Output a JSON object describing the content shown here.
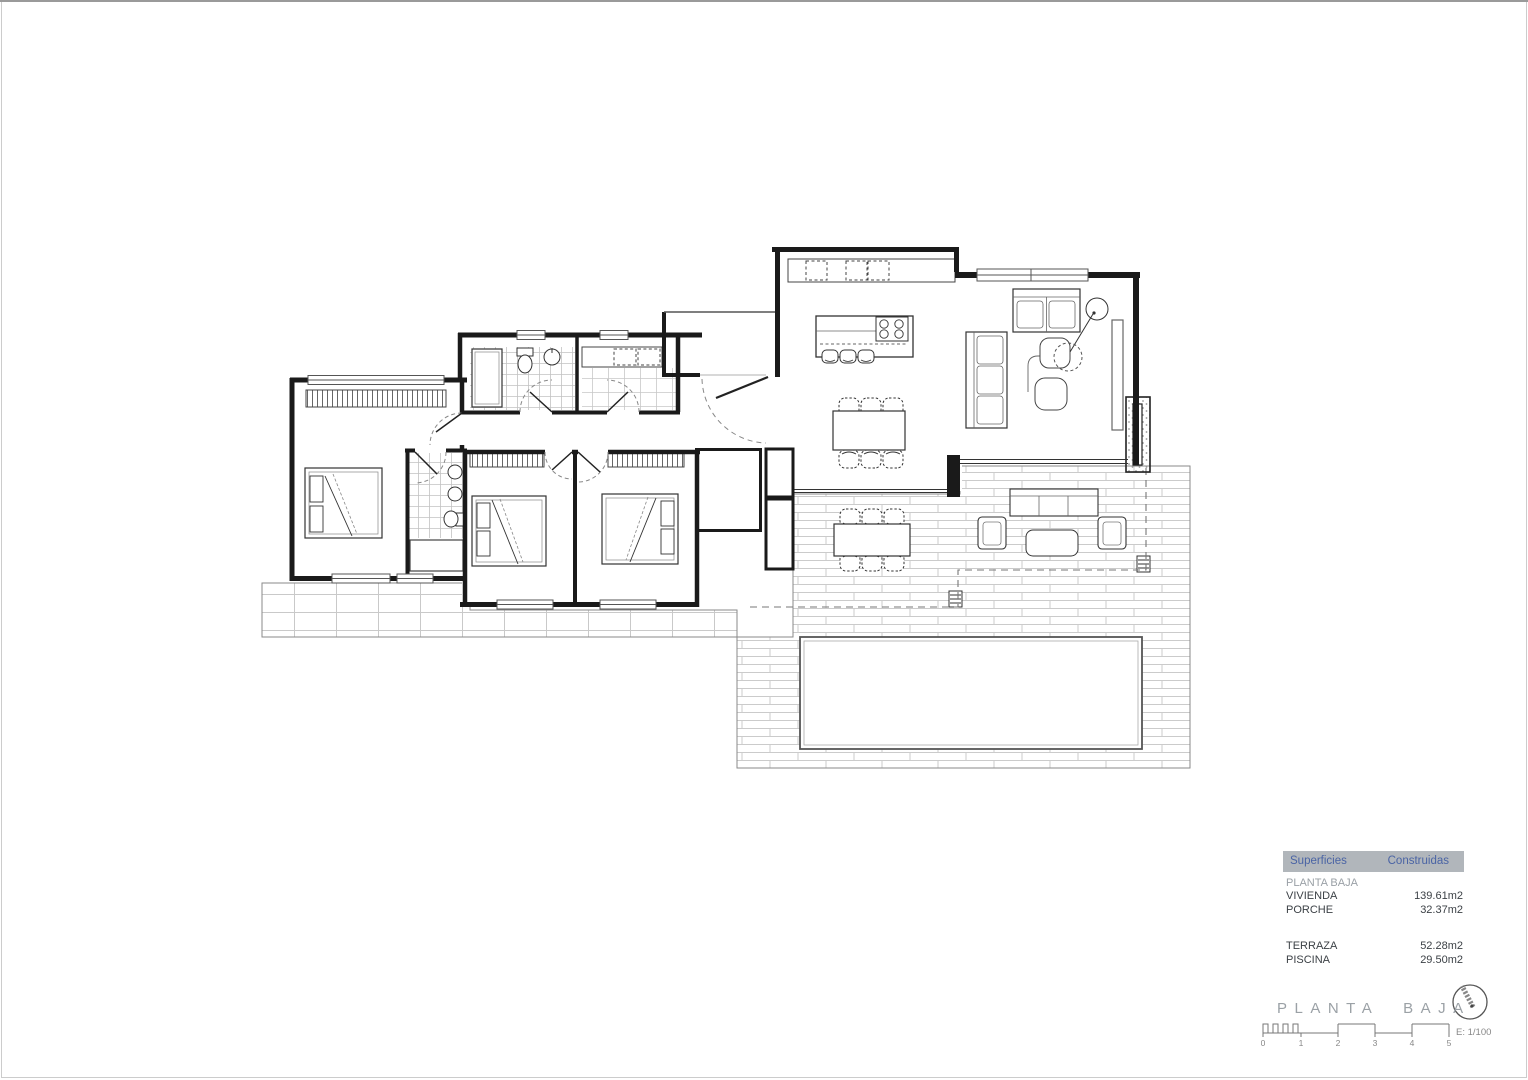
{
  "summary_table": {
    "header": {
      "col1": "Superficies",
      "col2": "Construidas"
    },
    "section_label": "PLANTA BAJA",
    "rows": [
      {
        "label": "VIVIENDA",
        "value": "139.61m2"
      },
      {
        "label": "PORCHE",
        "value": "32.37m2"
      },
      {
        "label": "TERRAZA",
        "value": "52.28m2"
      },
      {
        "label": "PISCINA",
        "value": "29.50m2"
      }
    ]
  },
  "title_block": {
    "title": "PLANTA BAJA",
    "scale_label": "E: 1/100",
    "scale_numbers": [
      "0",
      "1",
      "2",
      "3",
      "4",
      "5"
    ]
  },
  "colors": {
    "wall": "#1a1a1a",
    "furniture_line": "#333333",
    "tile_line": "#c9c9c9",
    "dashed_line": "#888888",
    "table_header_bg": "#b1b6bb",
    "table_header_text": "#4a64a5",
    "muted_text": "#9ba1a6",
    "page_border": "#cccccc"
  }
}
